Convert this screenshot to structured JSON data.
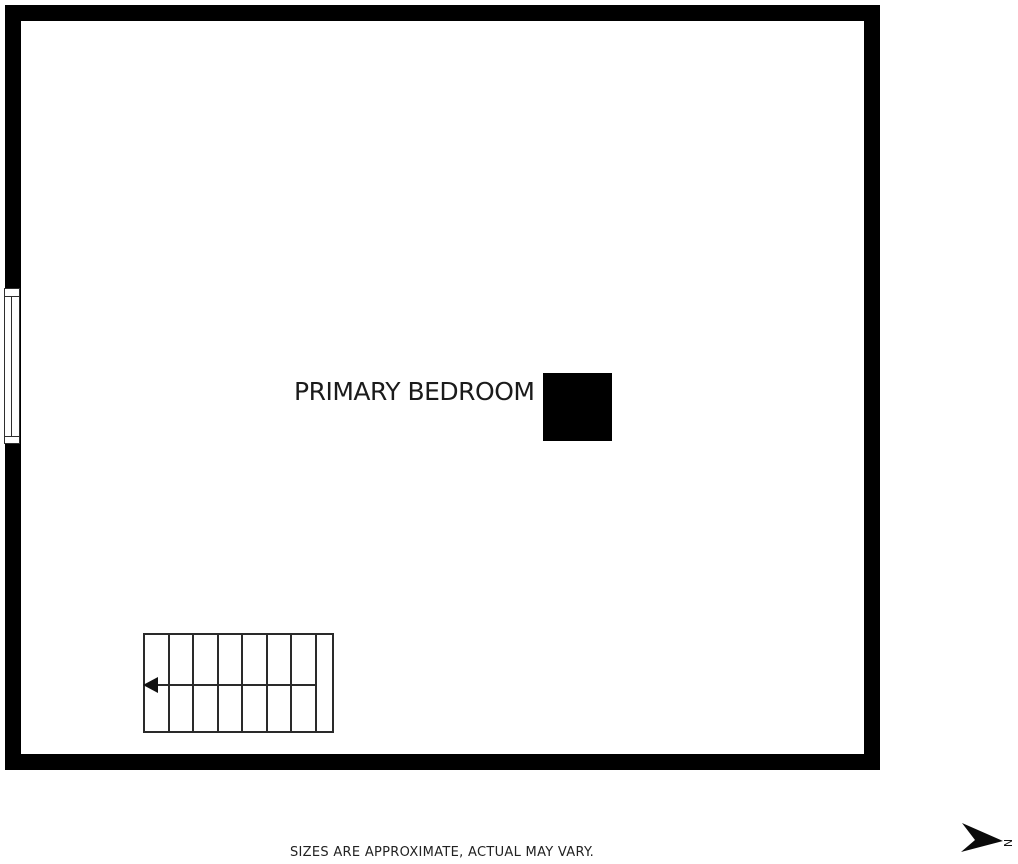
{
  "floorplan": {
    "room_label": "PRIMARY BEDROOM",
    "disclaimer": "SIZES ARE APPROXIMATE, ACTUAL MAY VARY.",
    "north_arrow": {
      "label": "N",
      "direction": "right"
    },
    "stairs": {
      "treads": 8,
      "arrow_direction": "left"
    },
    "window": {
      "wall": "left"
    },
    "colors": {
      "wall": "#000000",
      "line": "#2a2a2a",
      "text": "#1b1b1b",
      "background": "#ffffff"
    }
  }
}
